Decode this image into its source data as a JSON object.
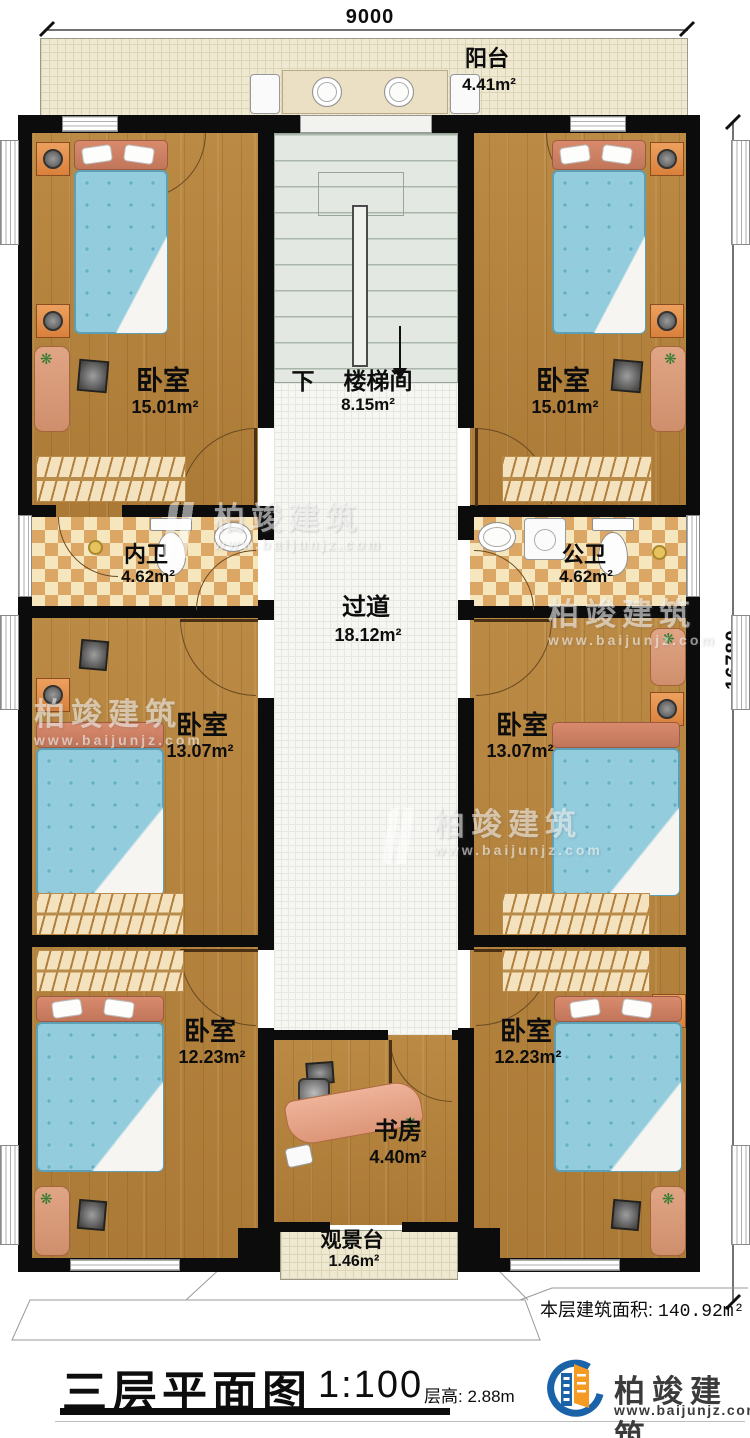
{
  "title_block": {
    "title": "三层平面图",
    "scale": "1:100",
    "floor_height": "层高: 2.88m",
    "area_label": "本层建筑面积:",
    "area_value": "140.92m²"
  },
  "dimensions": {
    "width": "9000",
    "height": "16780"
  },
  "rooms": {
    "balcony": {
      "name": "阳台",
      "area": "4.41m²"
    },
    "stair": {
      "prefix": "下",
      "name": "楼梯间",
      "area": "8.15m²"
    },
    "bedroom_tl": {
      "name": "卧室",
      "area": "15.01m²"
    },
    "bedroom_tr": {
      "name": "卧室",
      "area": "15.01m²"
    },
    "bath_left": {
      "name": "内卫",
      "area": "4.62m²"
    },
    "bath_right": {
      "name": "公卫",
      "area": "4.62m²"
    },
    "corridor": {
      "name": "过道",
      "area": "18.12m²"
    },
    "bedroom_ml": {
      "name": "卧室",
      "area": "13.07m²"
    },
    "bedroom_mr": {
      "name": "卧室",
      "area": "13.07m²"
    },
    "bedroom_bl": {
      "name": "卧室",
      "area": "12.23m²"
    },
    "bedroom_br": {
      "name": "卧室",
      "area": "12.23m²"
    },
    "study": {
      "name": "书房",
      "area": "4.40m²"
    },
    "deck": {
      "name": "观景台",
      "area": "1.46m²"
    }
  },
  "branding": {
    "company": "柏竣建筑",
    "website": "www.baijunjz.com"
  },
  "watermark": {
    "company": "柏竣建筑",
    "website": "www.baijunjz.com"
  },
  "colors": {
    "wall": "#0c0c0c",
    "wood": "#b5843f",
    "bed": "#92ccdd",
    "tile_light": "#f6e6bd",
    "tile_dark": "#dca765",
    "deck_floor": "#efe9d2",
    "stair_floor": "#e3e9e2",
    "brand_blue": "#1b63a8",
    "brand_orange": "#f59a23"
  }
}
